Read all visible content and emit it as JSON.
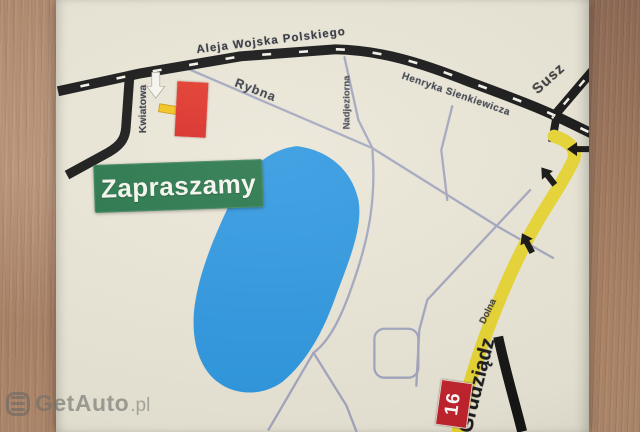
{
  "map": {
    "invite_label": "Zapraszamy",
    "streets": {
      "aleja": "Aleja Wojska Polskiego",
      "rybna": "Rybna",
      "kwiatowa": "Kwiatowa",
      "nadjeziorna": "Nadjeziorna",
      "sienkiewicza": "Henryka Sienkiewicza",
      "dolna": "Dolna"
    },
    "destinations": {
      "susz": "Susz",
      "grudziadz": "Grudziądz"
    },
    "route_number": "16",
    "colors": {
      "lake": "#2f98e0",
      "main_road": "#161616",
      "minor_road": "#a4a7bf",
      "highlighted_route": "#e9d634",
      "invite_bg": "#27764a",
      "marker_red": "#e0342b",
      "route_badge_red": "#c2232e",
      "paper": "#eae6d7"
    }
  },
  "watermark": {
    "brand": "GetAuto",
    "tld": ".pl"
  }
}
